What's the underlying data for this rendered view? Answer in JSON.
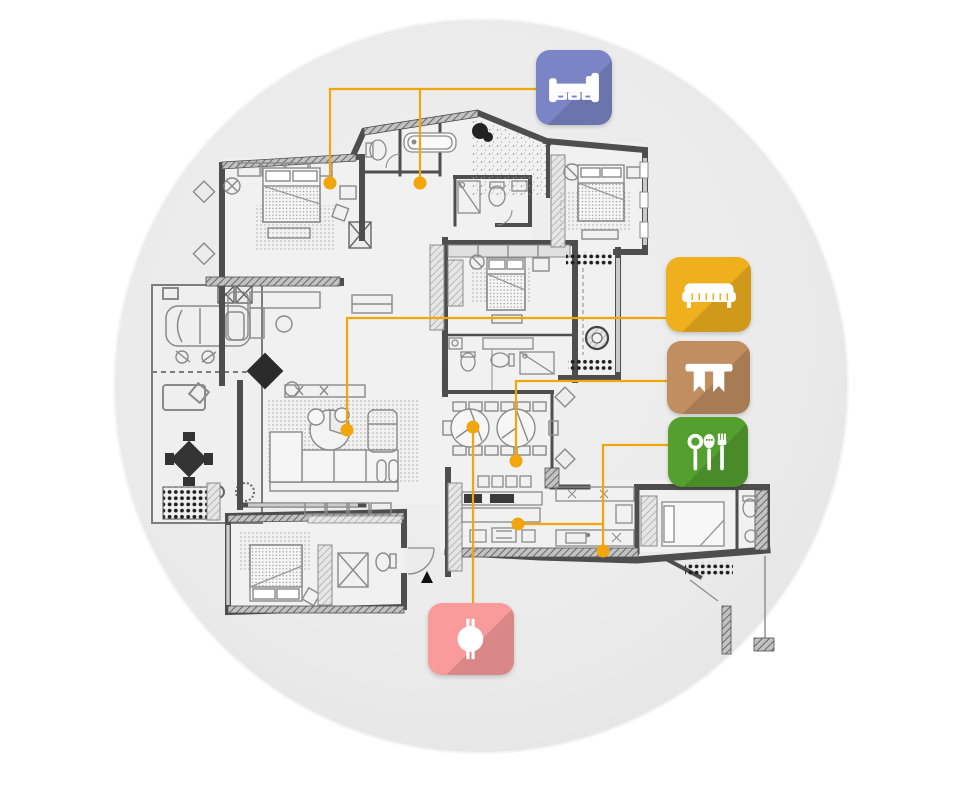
{
  "scene": {
    "background_color": "#ffffff",
    "circle": {
      "cx": 481,
      "cy": 386,
      "r": 368,
      "fill": "#ebebeb"
    },
    "description": "apartment floor plan infographic with room legend badges"
  },
  "palette": {
    "connector": "#F1A60B",
    "wall": "#4e4e4e",
    "furniture_line": "#8a8a8a",
    "accent_black": "#2b2b2b"
  },
  "legend": [
    {
      "id": "bedroom",
      "icon": "bed-icon",
      "color": "#7B85C6",
      "x": 536,
      "y": 50,
      "w": 76,
      "h": 75
    },
    {
      "id": "sofa",
      "icon": "sofa-icon",
      "color": "#EFB01E",
      "x": 666,
      "y": 257,
      "w": 85,
      "h": 75
    },
    {
      "id": "table",
      "icon": "table-icon",
      "color": "#C08E60",
      "x": 667,
      "y": 341,
      "w": 83,
      "h": 73
    },
    {
      "id": "kitchen",
      "icon": "cutlery-icon",
      "color": "#54A02E",
      "x": 668,
      "y": 417,
      "w": 80,
      "h": 70
    },
    {
      "id": "round-table",
      "icon": "round-table-icon",
      "color": "#F99B9B",
      "x": 428,
      "y": 603,
      "w": 86,
      "h": 72
    }
  ],
  "connectors": [
    {
      "for": "bedroom",
      "points": [
        [
          330,
          183
        ],
        [
          330,
          89
        ],
        [
          536,
          89
        ]
      ],
      "dots": [
        [
          330,
          183
        ]
      ]
    },
    {
      "for": "bedroom",
      "points": [
        [
          420,
          183
        ],
        [
          420,
          89
        ]
      ],
      "dots": [
        [
          420,
          183
        ]
      ]
    },
    {
      "for": "sofa",
      "points": [
        [
          347,
          430
        ],
        [
          347,
          318
        ],
        [
          666,
          318
        ]
      ],
      "dots": [
        [
          347,
          430
        ]
      ]
    },
    {
      "for": "table",
      "points": [
        [
          516,
          461
        ],
        [
          516,
          381
        ],
        [
          667,
          381
        ]
      ],
      "dots": [
        [
          516,
          461
        ]
      ]
    },
    {
      "for": "kitchen",
      "points": [
        [
          603,
          551
        ],
        [
          603,
          445
        ],
        [
          668,
          445
        ]
      ],
      "dots": [
        [
          603,
          551
        ]
      ]
    },
    {
      "for": "kitchen",
      "points": [
        [
          518,
          524
        ],
        [
          603,
          524
        ]
      ],
      "dots": [
        [
          518,
          524
        ]
      ]
    },
    {
      "for": "round-table",
      "points": [
        [
          473,
          427
        ],
        [
          473,
          603
        ]
      ],
      "dots": [
        [
          473,
          427
        ]
      ]
    }
  ],
  "floor_plan": {
    "rooms": [
      "master-bedroom",
      "bathroom-top",
      "terrace-top",
      "bedroom-top-right",
      "bedroom-middle",
      "bathroom-middle",
      "balcony-right",
      "study-lounge",
      "living-room",
      "dining-room",
      "kitchen-left",
      "kitchen-right",
      "bedroom-bottom-left",
      "bathroom-bottom",
      "maid-room",
      "maid-bathroom",
      "garage",
      "patio-left",
      "service-yard",
      "entry"
    ]
  }
}
